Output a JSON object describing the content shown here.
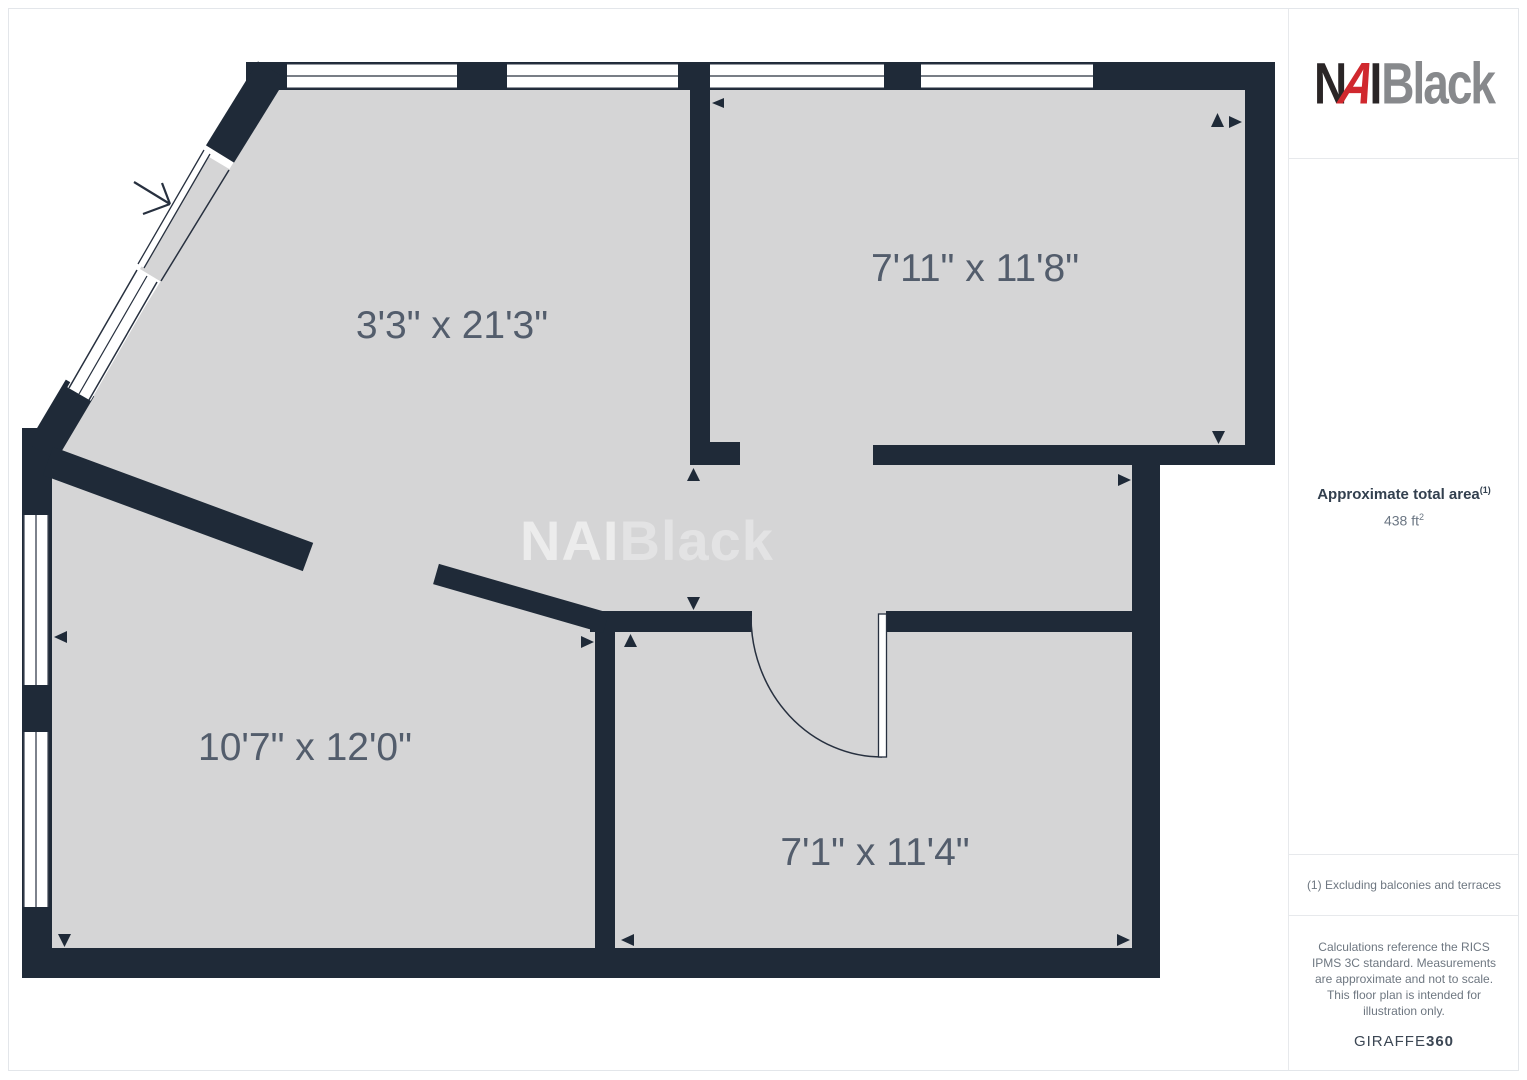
{
  "plan": {
    "rooms": [
      {
        "label": "3'3\" x 21'3\""
      },
      {
        "label": "7'11\" x 11'8\""
      },
      {
        "label": "10'7\" x 12'0\""
      },
      {
        "label": "7'1\" x 11'4\""
      }
    ],
    "watermark": {
      "part1": "NAI",
      "part2": "Black"
    },
    "colors": {
      "wall": "#1f2a38",
      "floor": "#d5d5d6",
      "label": "#535d6c"
    }
  },
  "sidebar": {
    "logo": {
      "n": "N",
      "a": "A",
      "i": "I",
      "suffix": "Black",
      "red": "#d0282e",
      "dark": "#2a2526",
      "gray": "#87898c"
    },
    "total_area": {
      "title": "Approximate total area",
      "title_sup": "(1)",
      "value": "438 ft",
      "value_sup": "2"
    },
    "footnote": "(1) Excluding balconies and terraces",
    "disclaimer": "Calculations reference the RICS IPMS 3C standard. Measurements are approximate and not to scale. This floor plan is intended for illustration only.",
    "brand": {
      "regular": "GIRAFFE",
      "bold": "360"
    }
  }
}
